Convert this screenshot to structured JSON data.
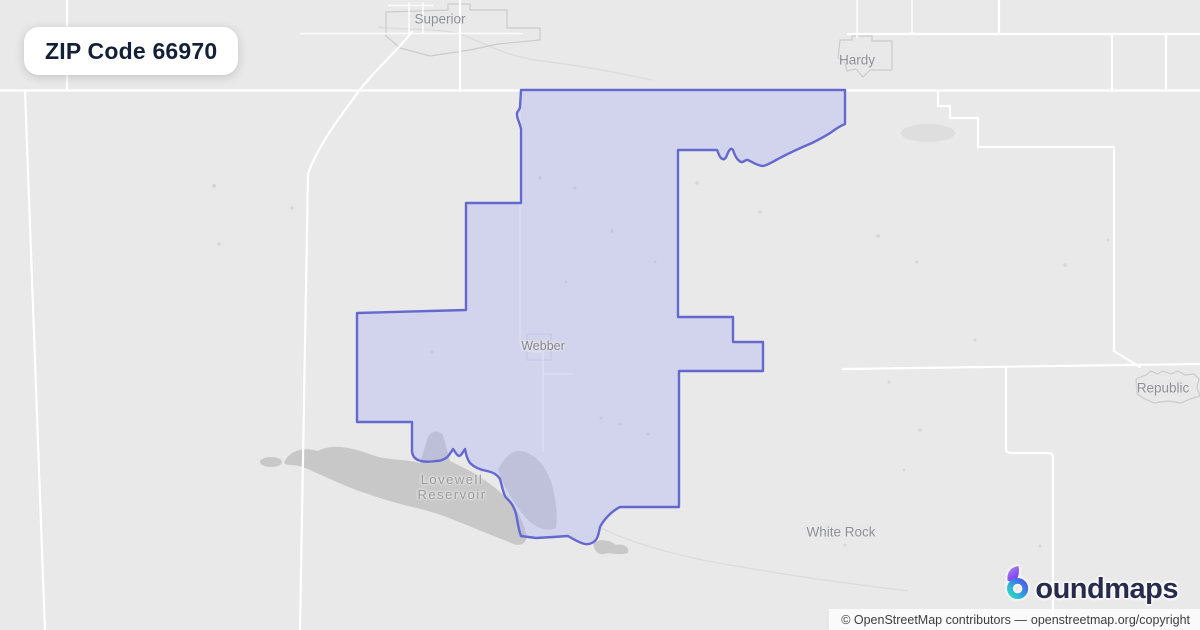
{
  "badge": {
    "label": "ZIP Code 66970"
  },
  "map": {
    "colors": {
      "background": "#e9e9e9",
      "road": "#ffffff",
      "boundary_stroke": "#6569cf",
      "boundary_fill": "rgba(168,176,248,0.35)",
      "water": "#c8c8c8"
    },
    "labels": [
      {
        "id": "superior",
        "text": "Superior"
      },
      {
        "id": "hardy",
        "text": "Hardy"
      },
      {
        "id": "webber",
        "text": "Webber"
      },
      {
        "id": "lovewell-reservoir",
        "line1": "Lovewell",
        "line2": "Reservoir"
      },
      {
        "id": "republic",
        "text": "Republic"
      },
      {
        "id": "white-rock",
        "text": "White Rock"
      }
    ]
  },
  "logo": {
    "brand": "boundmaps",
    "brand_rest": "oundmaps"
  },
  "attribution": {
    "prefix": "© OpenStreetMap contributors —",
    "link": "openstreetmap.org/copyright"
  }
}
